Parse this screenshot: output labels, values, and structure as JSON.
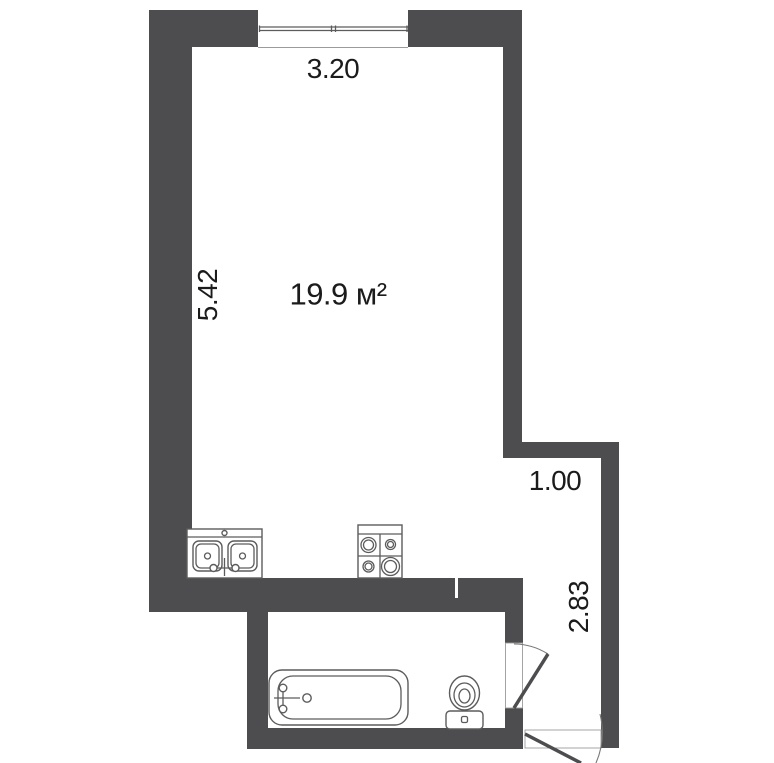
{
  "plan": {
    "area_label": "19.9 м²",
    "dimensions": {
      "top_width_m": "3.20",
      "left_height_m": "5.42",
      "niche_width_m": "1.00",
      "right_height_m": "2.83"
    }
  },
  "fixtures": {
    "window": "window",
    "kitchen_sink": "double-basin-kitchen-sink",
    "stove": "four-burner-stove",
    "bathtub": "bathtub",
    "toilet": "toilet",
    "bathroom_door": "bathroom-door-swing",
    "entrance_door": "entrance-door-swing"
  },
  "colors": {
    "wall": "#4d4d4f",
    "background": "#ffffff",
    "fixture_stroke": "#5c5c5c",
    "thin_line": "#9b9b9b",
    "text": "#1b1b1b"
  }
}
